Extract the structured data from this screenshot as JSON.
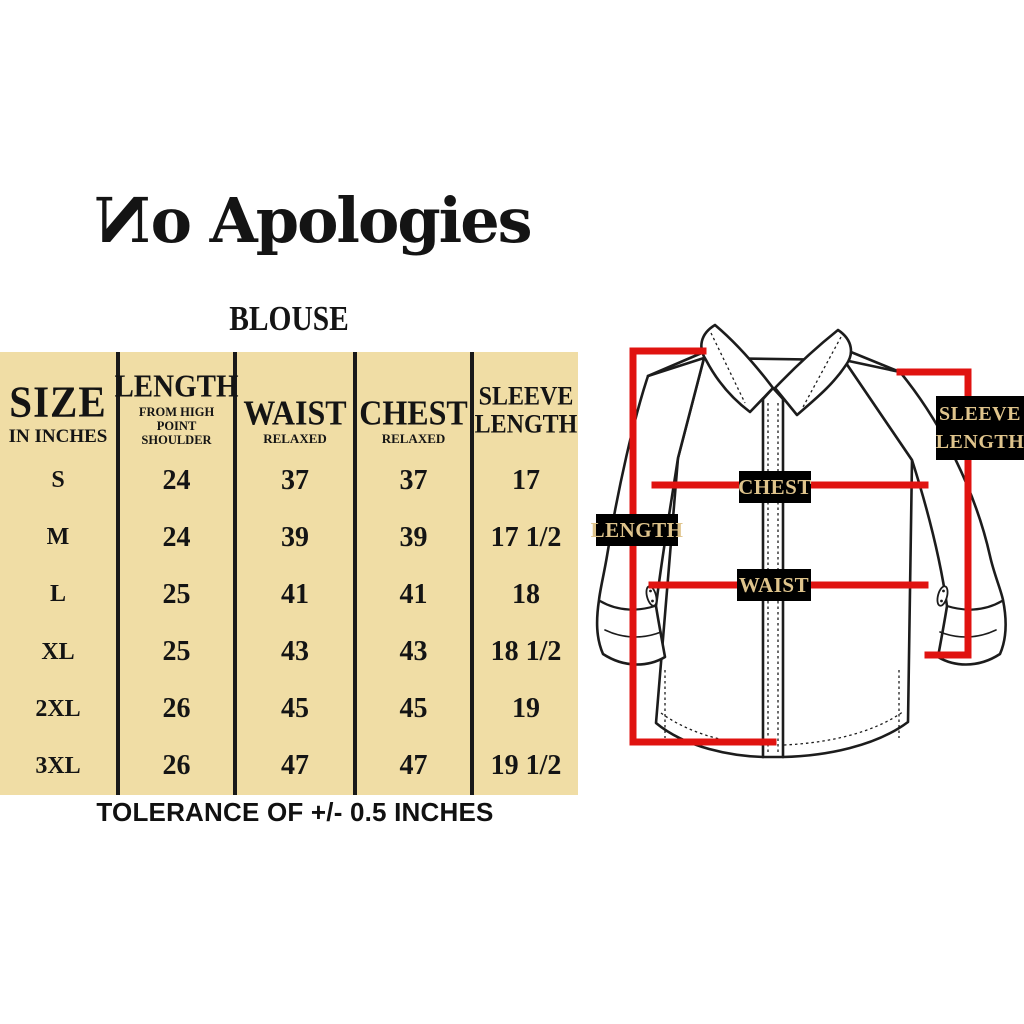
{
  "brand": {
    "name": "No Apologies",
    "logo_first_letter": "N",
    "logo_rest": "o Apologies"
  },
  "title": "BLOUSE",
  "size_chart": {
    "columns": [
      {
        "title": "SIZE",
        "subtitle": "IN INCHES"
      },
      {
        "title": "LENGTH",
        "subtitle": "FROM HIGH POINT SHOULDER"
      },
      {
        "title": "WAIST",
        "subtitle": "RELAXED"
      },
      {
        "title": "CHEST",
        "subtitle": "RELAXED"
      },
      {
        "title": "SLEEVE LENGTH",
        "subtitle": ""
      }
    ],
    "rows": [
      {
        "size": "S",
        "length": "24",
        "waist": "37",
        "chest": "37",
        "sleeve": "17"
      },
      {
        "size": "M",
        "length": "24",
        "waist": "39",
        "chest": "39",
        "sleeve": "17 1/2"
      },
      {
        "size": "L",
        "length": "25",
        "waist": "41",
        "chest": "41",
        "sleeve": "18"
      },
      {
        "size": "XL",
        "length": "25",
        "waist": "43",
        "chest": "43",
        "sleeve": "18 1/2"
      },
      {
        "size": "2XL",
        "length": "26",
        "waist": "45",
        "chest": "45",
        "sleeve": "19"
      },
      {
        "size": "3XL",
        "length": "26",
        "waist": "47",
        "chest": "47",
        "sleeve": "19 1/2"
      }
    ],
    "tolerance_note": "TOLERANCE OF +/- 0.5 INCHES"
  },
  "diagram": {
    "labels": {
      "length": "LENGTH",
      "chest": "CHEST",
      "waist": "WAIST",
      "sleeve": "SLEEVE LENGTH"
    }
  },
  "colors": {
    "table_background": "#f0dda5",
    "measurement_red": "#e01310",
    "label_background": "#000000",
    "label_text": "#dfc48c",
    "ink": "#1a1a1a"
  },
  "chart_data": {
    "type": "table",
    "title": "BLOUSE",
    "unit": "inches",
    "columns": [
      "SIZE IN INCHES",
      "LENGTH FROM HIGH POINT SHOULDER",
      "WAIST RELAXED",
      "CHEST RELAXED",
      "SLEEVE LENGTH"
    ],
    "rows": [
      [
        "S",
        "24",
        "37",
        "37",
        "17"
      ],
      [
        "M",
        "24",
        "39",
        "39",
        "17 1/2"
      ],
      [
        "L",
        "25",
        "41",
        "41",
        "18"
      ],
      [
        "XL",
        "25",
        "43",
        "43",
        "18 1/2"
      ],
      [
        "2XL",
        "26",
        "45",
        "45",
        "19"
      ],
      [
        "3XL",
        "26",
        "47",
        "47",
        "19 1/2"
      ]
    ],
    "note": "TOLERANCE OF +/- 0.5 INCHES"
  }
}
